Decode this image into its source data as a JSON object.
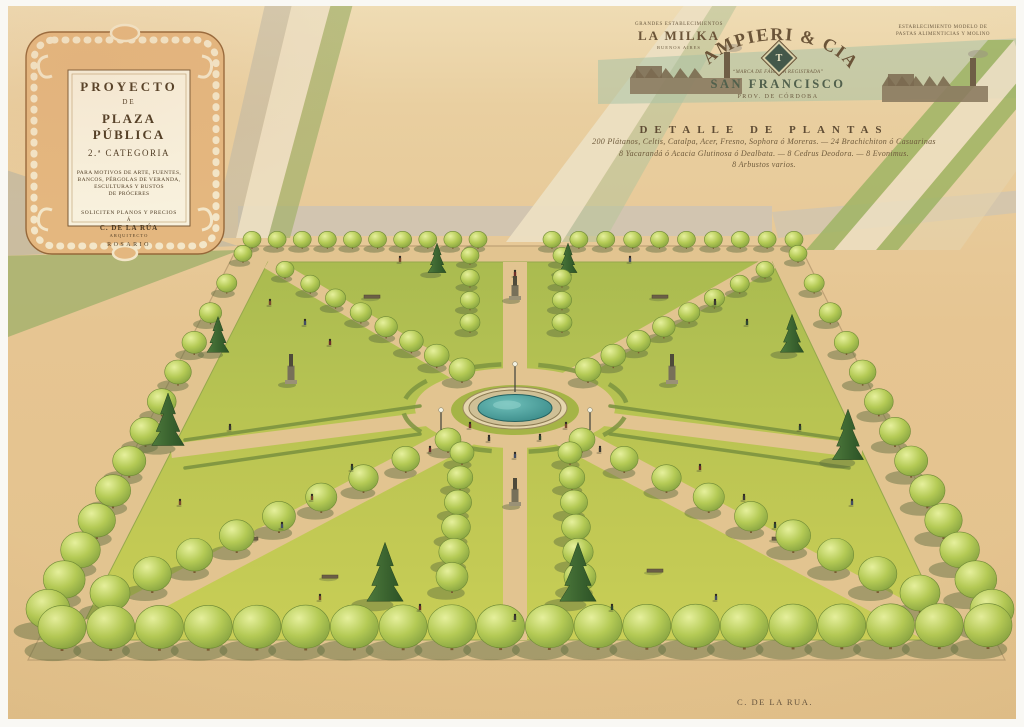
{
  "cartouche": {
    "title_line1": "PROYECTO",
    "title_line2": "DE",
    "title_line3": "PLAZA PÚBLICA",
    "title_line4": "2.ª CATEGORIA",
    "body_lines": [
      "PARA MOTIVOS DE ARTE, FUENTES,",
      "BANCOS, PÉRGOLAS DE VERANDA,",
      "ESCULTURAS Y BUSTOS",
      "DE PRÓCERES"
    ],
    "footer_line1": "SOLICITEN PLANOS Y PRECIOS",
    "footer_a": "Á",
    "footer_name": "C. DE LA RÚA",
    "footer_role": "ARQUITECTO",
    "footer_city": "ROSARIO"
  },
  "letterhead": {
    "left": {
      "top": "GRANDES ESTABLECIMIENTOS",
      "name": "LA MILKA",
      "sub": "BUENOS AIRES"
    },
    "center": {
      "name": "TAMPIERI & CIA.",
      "monogram": "T",
      "motto": "“MARCA DE FÁBRICA REGISTRADA”",
      "city": "SAN FRANCISCO",
      "province": "PROV. DE CÓRDOBA"
    },
    "right": {
      "line1": "ESTABLECIMIENTO MODELO DE",
      "line2": "PASTAS ALIMENTICIAS Y MOLINO"
    }
  },
  "plant_detail": {
    "title": "DETALLE DE PLANTAS",
    "lines": [
      "200 Plátanos, Celtis, Catalpa, Acer, Fresno, Sophora ó Moreras. — 24 Brachichiton ó Casuarinas",
      "8 Yacarandá ó Acacia Glutinosa ó Dealbata. — 8 Cedrus Deodora. — 8 Evonimus.",
      "8 Arbustos varios."
    ]
  },
  "signature": "C. DE LA RUA.",
  "palette": {
    "paper_top": "#efdcb4",
    "paper_mid": "#e7c795",
    "paper_bottom": "#e3c28c",
    "walk": "#e2c490",
    "curb": "#bfa275",
    "lawn_front": "#c9cf55",
    "lawn_back": "#a9bb4e",
    "tree_light": "#e6f09c",
    "tree_mid": "#b4ca55",
    "tree_dark": "#7c9a3c",
    "tree_outline": "#6f8a36",
    "shadow": "#5c6b3d",
    "conifer_light": "#4e7a3c",
    "conifer_dark": "#2c5226",
    "water_light": "#6fc0ba",
    "water_dark": "#2f7f7e",
    "hedge": "#7d9440",
    "ink": "#4c3a22"
  },
  "scene": {
    "plaza_outer": [
      [
        238,
        246
      ],
      [
        800,
        246
      ],
      [
        1005,
        660
      ],
      [
        28,
        660
      ]
    ],
    "plaza_inner": [
      [
        268,
        262
      ],
      [
        772,
        262
      ],
      [
        952,
        640
      ],
      [
        75,
        640
      ]
    ],
    "center": [
      515,
      408
    ],
    "surround": [
      {
        "pts": [
          [
            238,
            206
          ],
          [
            772,
            206
          ],
          [
            772,
            236
          ],
          [
            238,
            236
          ]
        ],
        "fill": "#cfc4b2",
        "op": 0.9
      },
      {
        "pts": [
          [
            772,
            212
          ],
          [
            1024,
            190
          ],
          [
            1024,
            212
          ],
          [
            778,
            238
          ]
        ],
        "fill": "#cfc4b2",
        "op": 0.75
      },
      {
        "pts": [
          [
            0,
            168
          ],
          [
            238,
            246
          ],
          [
            0,
            256
          ]
        ],
        "fill": "#bdb6a2",
        "op": 0.7
      },
      {
        "pts": [
          [
            0,
            256
          ],
          [
            240,
            250
          ],
          [
            0,
            340
          ]
        ],
        "fill": "#a2b06b",
        "op": 0.8
      },
      {
        "pts": [
          [
            293,
            0
          ],
          [
            332,
            0
          ],
          [
            268,
            238
          ],
          [
            236,
            238
          ]
        ],
        "fill": "#ecdfc2",
        "op": 0.9
      },
      {
        "pts": [
          [
            332,
            0
          ],
          [
            354,
            0
          ],
          [
            290,
            238
          ],
          [
            268,
            238
          ]
        ],
        "fill": "#a2b06b",
        "op": 0.7
      },
      {
        "pts": [
          [
            266,
            0
          ],
          [
            293,
            0
          ],
          [
            236,
            238
          ],
          [
            212,
            238
          ]
        ],
        "fill": "#c2bba7",
        "op": 0.6
      },
      {
        "pts": [
          [
            688,
            0
          ],
          [
            716,
            0
          ],
          [
            562,
            242
          ],
          [
            506,
            242
          ]
        ],
        "fill": "#ecdfc2",
        "op": 0.95
      },
      {
        "pts": [
          [
            716,
            0
          ],
          [
            740,
            0
          ],
          [
            604,
            242
          ],
          [
            562,
            242
          ]
        ],
        "fill": "#b9c49b",
        "op": 0.6
      },
      {
        "pts": [
          [
            598,
            60
          ],
          [
            1024,
            38
          ],
          [
            1024,
            98
          ],
          [
            598,
            104
          ]
        ],
        "fill": "#a9c3a6",
        "op": 0.55
      },
      {
        "pts": [
          [
            806,
            250
          ],
          [
            834,
            250
          ],
          [
            1014,
            40
          ],
          [
            988,
            40
          ]
        ],
        "fill": "#9fb464",
        "op": 0.85
      },
      {
        "pts": [
          [
            876,
            250
          ],
          [
            898,
            250
          ],
          [
            1024,
            100
          ],
          [
            1024,
            74
          ]
        ],
        "fill": "#9fb464",
        "op": 0.85
      },
      {
        "pts": [
          [
            834,
            250
          ],
          [
            876,
            250
          ],
          [
            1024,
            74
          ],
          [
            1014,
            40
          ]
        ],
        "fill": "#ecdfc2",
        "op": 0.85
      },
      {
        "pts": [
          [
            898,
            250
          ],
          [
            960,
            250
          ],
          [
            1024,
            160
          ],
          [
            1024,
            100
          ]
        ],
        "fill": "#e6d4ae",
        "op": 0.6
      }
    ],
    "factories": [
      {
        "x": 630,
        "y": 50,
        "w": 112,
        "h": 44
      },
      {
        "x": 882,
        "y": 56,
        "w": 106,
        "h": 46
      }
    ],
    "fountain": {
      "cx": 515,
      "cy": 408,
      "mound_rx": 64,
      "mound_ry": 25,
      "ring_rx": 100,
      "ring_ry": 40,
      "rim_rx": 46,
      "rim_ry": 18,
      "water_rx": 37,
      "water_ry": 13.5
    },
    "paths": {
      "axis_width": 24,
      "diag_back_width": 14,
      "diag_front_width": 26,
      "mid_width": 14,
      "left_mid": [
        171,
        451
      ],
      "right_mid": [
        862,
        451
      ]
    },
    "ring_arcs": {
      "rx": 112,
      "ry": 44,
      "segments": 8
    },
    "hedges": [
      {
        "x1": 185,
        "y1": 440,
        "x2": 420,
        "y2": 406
      },
      {
        "x1": 185,
        "y1": 468,
        "x2": 420,
        "y2": 434
      },
      {
        "x1": 849,
        "y1": 440,
        "x2": 610,
        "y2": 406
      },
      {
        "x1": 849,
        "y1": 468,
        "x2": 610,
        "y2": 434
      }
    ],
    "tree_rows": [
      {
        "name": "back-left",
        "x1": 252,
        "y1": 248,
        "x2": 478,
        "y2": 248,
        "n": 10,
        "r1": 9,
        "r2": 9
      },
      {
        "name": "back-right",
        "x1": 552,
        "y1": 248,
        "x2": 794,
        "y2": 248,
        "n": 10,
        "r1": 9,
        "r2": 9
      },
      {
        "name": "left",
        "x1": 243,
        "y1": 262,
        "x2": 48,
        "y2": 630,
        "n": 13,
        "r1": 9,
        "r2": 22
      },
      {
        "name": "right",
        "x1": 798,
        "y1": 262,
        "x2": 992,
        "y2": 630,
        "n": 13,
        "r1": 9,
        "r2": 22
      },
      {
        "name": "front",
        "x1": 62,
        "y1": 650,
        "x2": 988,
        "y2": 648,
        "n": 20,
        "r1": 24,
        "r2": 24
      },
      {
        "name": "nw-diagonal",
        "x1": 285,
        "y1": 278,
        "x2": 462,
        "y2": 382,
        "n": 8,
        "r1": 9,
        "r2": 13
      },
      {
        "name": "ne-diagonal",
        "x1": 765,
        "y1": 278,
        "x2": 588,
        "y2": 382,
        "n": 8,
        "r1": 9,
        "r2": 13
      },
      {
        "name": "sw-diagonal",
        "x1": 110,
        "y1": 612,
        "x2": 448,
        "y2": 452,
        "n": 9,
        "r1": 20,
        "r2": 13
      },
      {
        "name": "se-diagonal",
        "x1": 920,
        "y1": 612,
        "x2": 582,
        "y2": 452,
        "n": 9,
        "r1": 20,
        "r2": 13
      },
      {
        "name": "axis-top-left",
        "x1": 470,
        "y1": 264,
        "x2": 470,
        "y2": 332,
        "n": 4,
        "r1": 9,
        "r2": 10
      },
      {
        "name": "axis-top-right",
        "x1": 562,
        "y1": 264,
        "x2": 562,
        "y2": 332,
        "n": 4,
        "r1": 9,
        "r2": 10
      },
      {
        "name": "axis-bottom-left",
        "x1": 462,
        "y1": 464,
        "x2": 452,
        "y2": 592,
        "n": 6,
        "r1": 12,
        "r2": 16
      },
      {
        "name": "axis-bottom-right",
        "x1": 570,
        "y1": 464,
        "x2": 580,
        "y2": 592,
        "n": 6,
        "r1": 12,
        "r2": 16
      }
    ],
    "conifers": [
      {
        "x": 168,
        "y": 448,
        "s": 1.25
      },
      {
        "x": 218,
        "y": 354,
        "s": 0.85
      },
      {
        "x": 792,
        "y": 354,
        "s": 0.9
      },
      {
        "x": 848,
        "y": 462,
        "s": 1.2
      },
      {
        "x": 385,
        "y": 604,
        "s": 1.4
      },
      {
        "x": 578,
        "y": 604,
        "s": 1.4
      },
      {
        "x": 437,
        "y": 274,
        "s": 0.7
      },
      {
        "x": 568,
        "y": 274,
        "s": 0.7
      }
    ],
    "monuments": [
      {
        "x": 291,
        "y": 384,
        "h": 26
      },
      {
        "x": 672,
        "y": 384,
        "h": 26
      },
      {
        "x": 515,
        "y": 300,
        "h": 20
      },
      {
        "x": 515,
        "y": 506,
        "h": 24
      }
    ],
    "lamps": [
      {
        "x": 515,
        "y": 392,
        "h": 26
      },
      {
        "x": 441,
        "y": 430,
        "h": 18
      },
      {
        "x": 590,
        "y": 430,
        "h": 18
      }
    ],
    "benches": [
      [
        330,
        578
      ],
      [
        655,
        572
      ],
      [
        372,
        298
      ],
      [
        660,
        298
      ],
      [
        250,
        540
      ],
      [
        780,
        540
      ]
    ],
    "people": [
      [
        470,
        428
      ],
      [
        489,
        441
      ],
      [
        540,
        440
      ],
      [
        566,
        428
      ],
      [
        515,
        458
      ],
      [
        430,
        452
      ],
      [
        600,
        452
      ],
      [
        352,
        470
      ],
      [
        312,
        500
      ],
      [
        282,
        528
      ],
      [
        700,
        470
      ],
      [
        744,
        500
      ],
      [
        775,
        528
      ],
      [
        270,
        305
      ],
      [
        305,
        325
      ],
      [
        330,
        345
      ],
      [
        715,
        305
      ],
      [
        747,
        325
      ],
      [
        400,
        262
      ],
      [
        630,
        262
      ],
      [
        515,
        276
      ],
      [
        230,
        430
      ],
      [
        800,
        430
      ],
      [
        180,
        505
      ],
      [
        852,
        505
      ],
      [
        420,
        610
      ],
      [
        515,
        620
      ],
      [
        612,
        610
      ],
      [
        320,
        600
      ],
      [
        716,
        600
      ]
    ],
    "person_colors": [
      "#6e2f2a",
      "#3c3a33",
      "#2e4630",
      "#7a4a2e",
      "#444d63"
    ]
  }
}
